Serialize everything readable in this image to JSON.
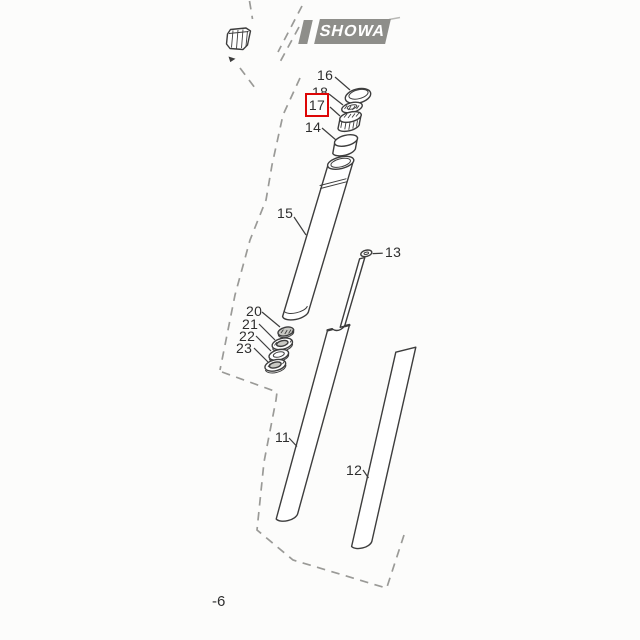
{
  "brand_badge": {
    "text": "SHOWA"
  },
  "region_reference": {
    "text": "-6"
  },
  "highlight": {
    "part_number": "17"
  },
  "parts": [
    {
      "number": "16",
      "highlighted": false
    },
    {
      "number": "18",
      "highlighted": false
    },
    {
      "number": "17",
      "highlighted": true
    },
    {
      "number": "14",
      "highlighted": false
    },
    {
      "number": "15",
      "highlighted": false
    },
    {
      "number": "13",
      "highlighted": false
    },
    {
      "number": "20",
      "highlighted": false
    },
    {
      "number": "21",
      "highlighted": false
    },
    {
      "number": "22",
      "highlighted": false
    },
    {
      "number": "23",
      "highlighted": false
    },
    {
      "number": "11",
      "highlighted": false
    },
    {
      "number": "12",
      "highlighted": false
    }
  ],
  "colors": {
    "background": "#fcfcfb",
    "line": "#3d3d3d",
    "dashed": "#9a9a97",
    "badge": "#8e8e8a",
    "badge_text": "#ffffff",
    "highlight": "#dd0606",
    "label_text": "#2e2e2e"
  }
}
